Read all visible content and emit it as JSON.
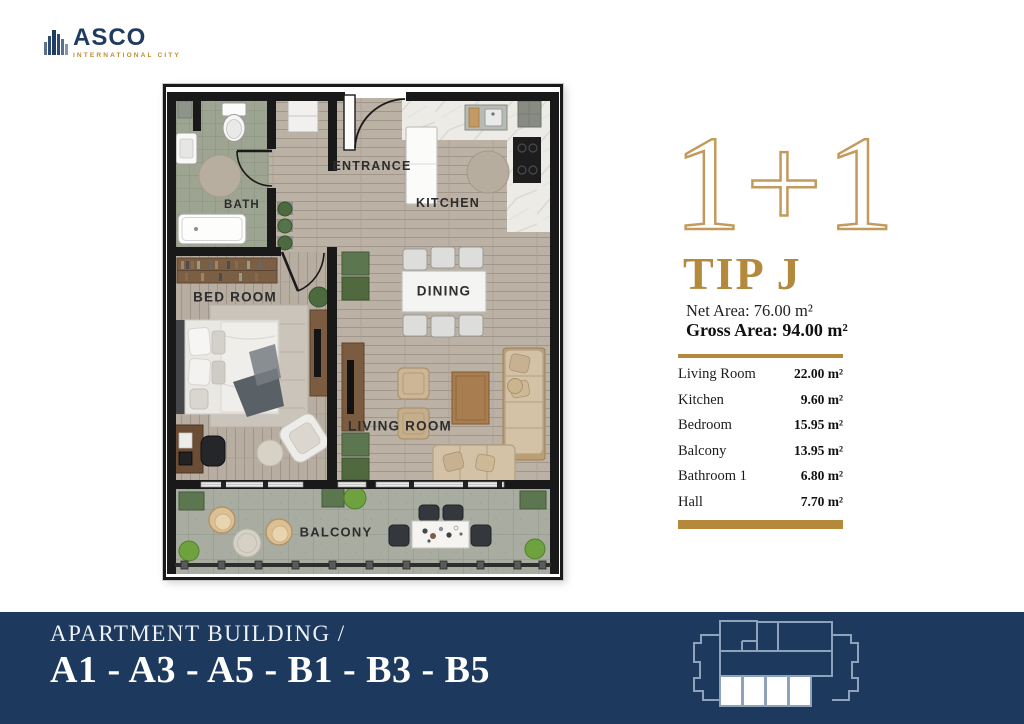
{
  "logo": {
    "brand": "ASCO",
    "tagline": "INTERNATIONAL CITY"
  },
  "floor_plan": {
    "labels": {
      "bath": "BATH",
      "entrance": "ENTRANCE",
      "kitchen": "KITCHEN",
      "dining": "DINING",
      "bedroom": "BED ROOM",
      "living_room": "LIVING ROOM",
      "balcony": "BALCONY"
    }
  },
  "panel": {
    "type_badge": "1+1",
    "type_name": "TIP J",
    "net_area": "Net Area: 76.00 m²",
    "gross_area": "Gross Area: 94.00 m²",
    "accent_color": "#b5893b",
    "rooms": [
      {
        "label": "Living Room",
        "value": "22.00 m²"
      },
      {
        "label": "Kitchen",
        "value": "9.60 m²"
      },
      {
        "label": "Bedroom",
        "value": "15.95 m²"
      },
      {
        "label": "Balcony",
        "value": "13.95 m²"
      },
      {
        "label": "Bathroom 1",
        "value": "6.80 m²"
      },
      {
        "label": "Hall",
        "value": "7.70 m²"
      }
    ]
  },
  "footer": {
    "line1": "APARTMENT BUILDING /",
    "line2": "A1 - A3 - A5 - B1 - B3 - B5",
    "bar_color": "#1d3a5e"
  }
}
